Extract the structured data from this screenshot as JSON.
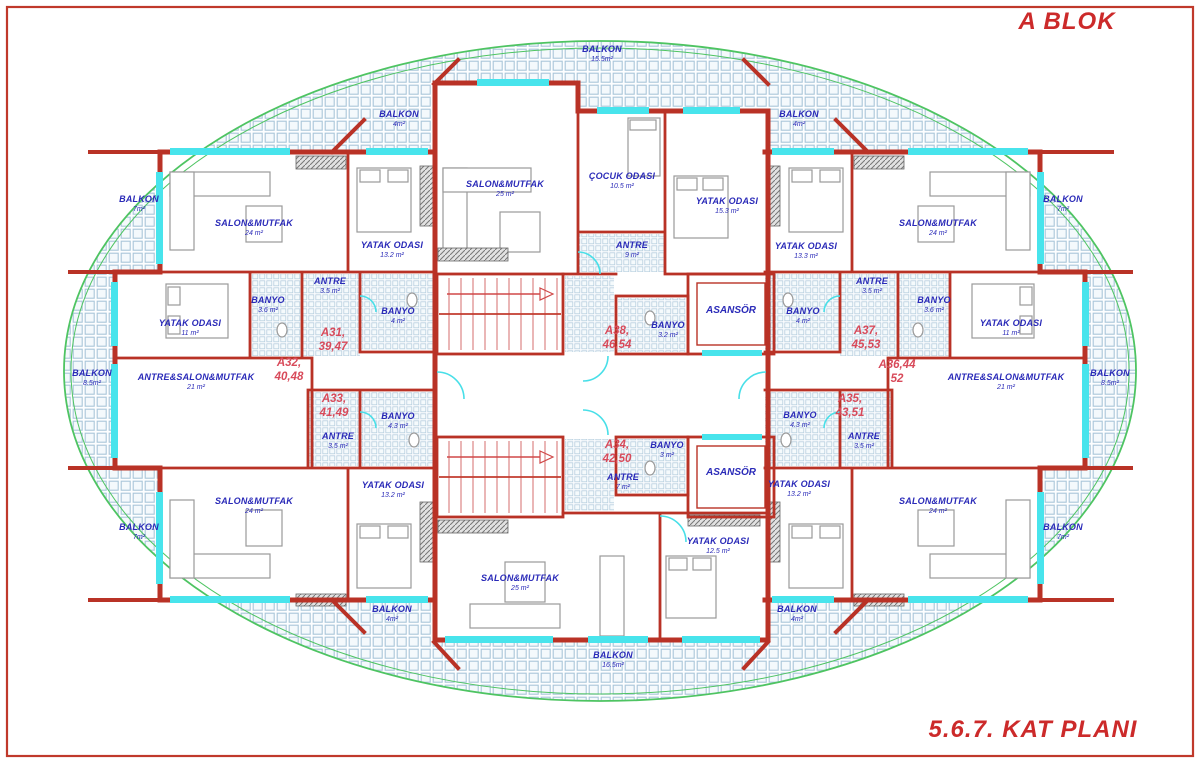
{
  "title": "A BLOK",
  "plan_title": "5.6.7. KAT PLANI",
  "colors": {
    "wall_red": "#b93226",
    "label_blue": "#2a2ab8",
    "apartment_red": "#d84a5a",
    "title_red": "#cc2a2a",
    "window_cyan": "#48e4ec",
    "tile_blue": "#a9c6d9",
    "outline_green": "#4ec462"
  },
  "rooms": [
    {
      "name": "BALKON",
      "area": "15.5m²",
      "x": 602,
      "y": 52
    },
    {
      "name": "BALKON",
      "area": "4m²",
      "x": 399,
      "y": 117
    },
    {
      "name": "BALKON",
      "area": "4m²",
      "x": 799,
      "y": 117
    },
    {
      "name": "BALKON",
      "area": "7m²",
      "x": 139,
      "y": 202
    },
    {
      "name": "BALKON",
      "area": "7m²",
      "x": 1063,
      "y": 202
    },
    {
      "name": "SALON&MUTFAK",
      "area": "24 m²",
      "x": 254,
      "y": 226
    },
    {
      "name": "SALON&MUTFAK",
      "area": "25 m²",
      "x": 505,
      "y": 187
    },
    {
      "name": "ÇOCUK ODASI",
      "area": "10.5 m²",
      "x": 622,
      "y": 179
    },
    {
      "name": "YATAK ODASI",
      "area": "15.3 m²",
      "x": 727,
      "y": 204
    },
    {
      "name": "YATAK ODASI",
      "area": "13.2 m²",
      "x": 392,
      "y": 248
    },
    {
      "name": "YATAK ODASI",
      "area": "13.3 m²",
      "x": 806,
      "y": 249
    },
    {
      "name": "SALON&MUTFAK",
      "area": "24 m²",
      "x": 938,
      "y": 226
    },
    {
      "name": "ANTRE",
      "area": "9 m²",
      "x": 632,
      "y": 248
    },
    {
      "name": "ANTRE",
      "area": "3.5 m²",
      "x": 330,
      "y": 284
    },
    {
      "name": "ANTRE",
      "area": "3.5 m²",
      "x": 872,
      "y": 284
    },
    {
      "name": "BANYO",
      "area": "3.6 m²",
      "x": 268,
      "y": 303
    },
    {
      "name": "BANYO",
      "area": "3.6 m²",
      "x": 934,
      "y": 303
    },
    {
      "name": "BANYO",
      "area": "4 m²",
      "x": 398,
      "y": 314
    },
    {
      "name": "BANYO",
      "area": "4 m²",
      "x": 803,
      "y": 314
    },
    {
      "name": "BANYO",
      "area": "3.2 m²",
      "x": 668,
      "y": 328
    },
    {
      "name": "YATAK ODASI",
      "area": "11 m²",
      "x": 190,
      "y": 326
    },
    {
      "name": "YATAK ODASI",
      "area": "11 m²",
      "x": 1011,
      "y": 326
    },
    {
      "name": "BALKON",
      "area": "8.5m²",
      "x": 92,
      "y": 376
    },
    {
      "name": "ANTRE&SALON&MUTFAK",
      "area": "21 m²",
      "x": 196,
      "y": 380
    },
    {
      "name": "ANTRE&SALON&MUTFAK",
      "area": "21 m²",
      "x": 1006,
      "y": 380
    },
    {
      "name": "BALKON",
      "area": "8.5m²",
      "x": 1110,
      "y": 376
    },
    {
      "name": "BANYO",
      "area": "4.3 m²",
      "x": 398,
      "y": 419
    },
    {
      "name": "BANYO",
      "area": "4.3 m²",
      "x": 800,
      "y": 418
    },
    {
      "name": "ANTRE",
      "area": "3.5 m²",
      "x": 338,
      "y": 439
    },
    {
      "name": "ANTRE",
      "area": "3.5 m²",
      "x": 864,
      "y": 439
    },
    {
      "name": "BANYO",
      "area": "3 m²",
      "x": 667,
      "y": 448
    },
    {
      "name": "ANTRE",
      "area": "7 m²",
      "x": 623,
      "y": 480
    },
    {
      "name": "YATAK ODASI",
      "area": "13.2 m²",
      "x": 393,
      "y": 488
    },
    {
      "name": "YATAK ODASI",
      "area": "13.2 m²",
      "x": 799,
      "y": 487
    },
    {
      "name": "SALON&MUTFAK",
      "area": "24 m²",
      "x": 254,
      "y": 504
    },
    {
      "name": "SALON&MUTFAK",
      "area": "24 m²",
      "x": 938,
      "y": 504
    },
    {
      "name": "BALKON",
      "area": "7m²",
      "x": 139,
      "y": 530
    },
    {
      "name": "BALKON",
      "area": "7m²",
      "x": 1063,
      "y": 530
    },
    {
      "name": "YATAK ODASI",
      "area": "12.5 m²",
      "x": 718,
      "y": 544
    },
    {
      "name": "SALON&MUTFAK",
      "area": "25 m²",
      "x": 520,
      "y": 581
    },
    {
      "name": "BALKON",
      "area": "4m²",
      "x": 392,
      "y": 612
    },
    {
      "name": "BALKON",
      "area": "4m²",
      "x": 797,
      "y": 612
    },
    {
      "name": "BALKON",
      "area": "16.5m²",
      "x": 613,
      "y": 658
    }
  ],
  "elevators": [
    {
      "label": "ASANSÖR",
      "x": 731,
      "y": 312
    },
    {
      "label": "ASANSÖR",
      "x": 731,
      "y": 474
    }
  ],
  "apartments": [
    {
      "line1": "A31,",
      "line2": "39,47",
      "x": 333,
      "y": 340
    },
    {
      "line1": "A32,",
      "line2": "40,48",
      "x": 289,
      "y": 370
    },
    {
      "line1": "A33,",
      "line2": "41,49",
      "x": 334,
      "y": 406
    },
    {
      "line1": "A34,",
      "line2": "42,50",
      "x": 617,
      "y": 452
    },
    {
      "line1": "A35,",
      "line2": "43,51",
      "x": 850,
      "y": 406
    },
    {
      "line1": "A36,44",
      "line2": "52",
      "x": 897,
      "y": 372
    },
    {
      "line1": "A37,",
      "line2": "45,53",
      "x": 866,
      "y": 338
    },
    {
      "line1": "A38,",
      "line2": "46,54",
      "x": 617,
      "y": 338
    }
  ]
}
